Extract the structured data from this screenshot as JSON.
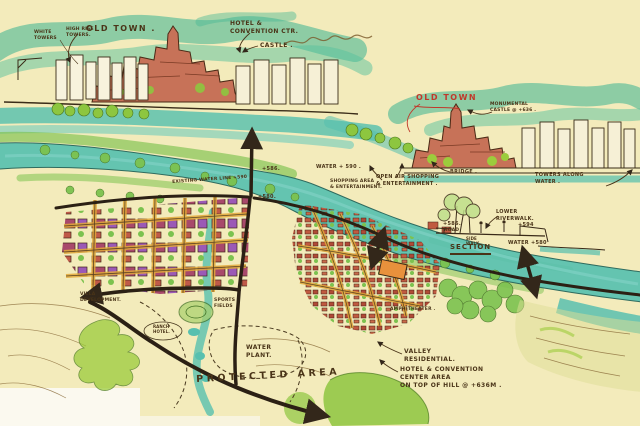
{
  "image_kind": "hand-drawn urban masterplan concept sketch (scanned marker drawing)",
  "colors": {
    "paper": "#f3ebbb",
    "water": "#58c0af",
    "hill_green": "#4ab795",
    "tree_green": "#7cc24f",
    "ink": "#4a3418",
    "red_label": "#c0392b",
    "building_red": "#c05a40",
    "building_purple": "#9b59b6",
    "road_yellow": "#e2a93a",
    "orange_block": "#e8913c"
  },
  "annotations": {
    "top_sketch": {
      "old_town": "OLD TOWN .",
      "hotel_convention": "HOTEL &\nCONVENTION CTR.",
      "castle": "CASTLE .",
      "white_towers": "WHITE\nTOWERS",
      "high_rise_towers": "HIGH RISE\nTOWERS."
    },
    "right_sketch": {
      "old_town": "OLD TOWN",
      "monumental_castle": "MONUMENTAL\nCASTLE @ +636 .",
      "bridge": "BRIDGE .",
      "towers_along_water": "TOWERS ALONG\nWATER .",
      "open_air_shopping": "OPEN AIR SHOPPING\n& ENTERTAINMENT ."
    },
    "section_detail": {
      "lower_riverwalk": "LOWER\nRIVERWALK.",
      "road_level": "+586.",
      "road": "ROAD",
      "sidewalk": "SIDE\nWALK",
      "upper_level": "+594",
      "title": "SECTION",
      "water_level": "WATER +580"
    },
    "plan": {
      "water_level": "WATER + 590 .",
      "existing_water_line": "EXISTING WATER LINE  +590",
      "level_586": "+586.",
      "level_580": "+580.",
      "shopping_area": "SHOPPING AREA\n& ENTERTAINMENT.",
      "amphitheater": "AMPHITHEATER .",
      "villa_development": "VILLA\nDEVELOPMENT.",
      "ranch_hotel": "RANCH\nHOTEL.",
      "sports_fields": "SPORTS\nFIELDS",
      "water_plant": "WATER\nPLANT.",
      "protected_area": "PROTECTED  AREA",
      "valley_residential": "VALLEY\nRESIDENTIAL.",
      "hotel_convention_area": "HOTEL & CONVENTION\nCENTER AREA\nON TOP OF HILL @ +636M ."
    }
  }
}
